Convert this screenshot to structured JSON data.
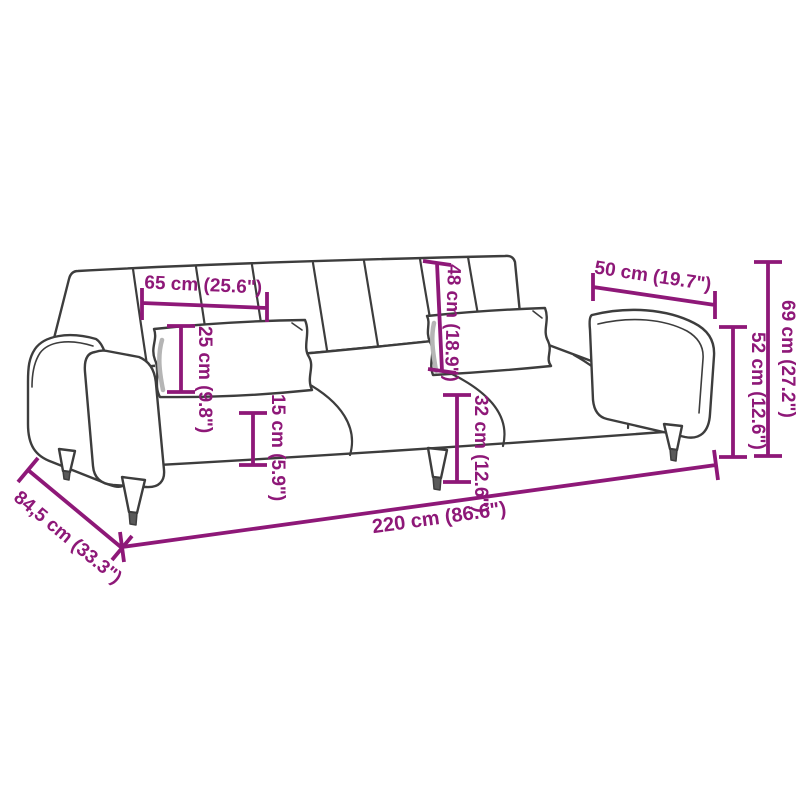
{
  "diagram": {
    "type": "product-dimension-diagram",
    "subject": "sofa-bed-line-drawing",
    "accent_color": "#8e1878",
    "line_color": "#3d3d3d",
    "background_color": "#ffffff",
    "dimensions": [
      {
        "id": "seat-section-width",
        "text": "65 cm (25.6\")",
        "cm": "65",
        "inch": "25.6"
      },
      {
        "id": "pillow-height",
        "text": "25 cm (9.8\")",
        "cm": "25",
        "inch": "9.8"
      },
      {
        "id": "seat-thickness",
        "text": "15 cm (5.9\")",
        "cm": "15",
        "inch": "5.9"
      },
      {
        "id": "backrest-height",
        "text": "48 cm (18.9\")",
        "cm": "48",
        "inch": "18.9"
      },
      {
        "id": "seat-height",
        "text": "32 cm (12.6\")",
        "cm": "32",
        "inch": "12.6"
      },
      {
        "id": "armrest-section-width",
        "text": "50 cm (19.7\")",
        "cm": "50",
        "inch": "19.7"
      },
      {
        "id": "armrest-height",
        "text": "52 cm (12.6\")",
        "cm": "52",
        "inch": "12.6"
      },
      {
        "id": "overall-height",
        "text": "69 cm (27.2\")",
        "cm": "69",
        "inch": "27.2"
      },
      {
        "id": "overall-width",
        "text": "220 cm (86.6\")",
        "cm": "220",
        "inch": "86.6"
      },
      {
        "id": "overall-depth",
        "text": "84,5 cm (33.3\")",
        "cm": "84,5",
        "inch": "33.3"
      }
    ]
  }
}
